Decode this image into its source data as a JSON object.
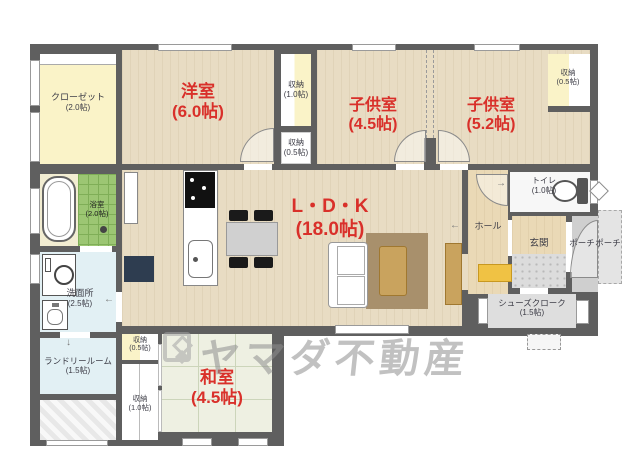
{
  "watermark": {
    "text": "ヤマダ不動産",
    "logo": "yamada-diamond-logo"
  },
  "rooms": {
    "closet": {
      "label": "クローゼット",
      "size": "(2.0帖)"
    },
    "west_room": {
      "label": "洋室",
      "size": "(6.0帖)"
    },
    "storage_a": {
      "label": "収納",
      "size": "(1.0帖)"
    },
    "storage_b": {
      "label": "収納",
      "size": "(0.5帖)"
    },
    "kids_room_1": {
      "label": "子供室",
      "size": "(4.5帖)"
    },
    "kids_room_2": {
      "label": "子供室",
      "size": "(5.2帖)"
    },
    "storage_c": {
      "label": "収納",
      "size": "(0.5帖)"
    },
    "toilet": {
      "label": "トイレ",
      "size": "(1.0帖)"
    },
    "hall": {
      "label": "ホール",
      "size": ""
    },
    "genkan": {
      "label": "玄関",
      "size": ""
    },
    "porch": {
      "label": "ポーチ",
      "size": ""
    },
    "porch_outer": {
      "label": "ポーチ",
      "size": ""
    },
    "shoes_closet": {
      "label": "シューズクローク",
      "size": "(1.5帖)"
    },
    "ldk": {
      "label": "L・D・K",
      "size": "(18.0帖)"
    },
    "bath": {
      "label": "浴室",
      "size": "(2.0帖)"
    },
    "washroom": {
      "label": "洗面所",
      "size": "(2.5帖)"
    },
    "laundry": {
      "label": "ランドリールーム",
      "size": "(1.5帖)"
    },
    "storage_d": {
      "label": "収納",
      "size": "(0.5帖)"
    },
    "storage_e": {
      "label": "収納",
      "size": "(1.0帖)"
    },
    "washitsu": {
      "label": "和室",
      "size": "(4.5帖)"
    }
  },
  "arrows": {
    "hall": "←",
    "washroom": "←",
    "toilet": "→",
    "laundry": "↓"
  },
  "furniture_icons": [
    "bathtub-icon",
    "shower-icon",
    "washing-machine-icon",
    "vanity-sink-icon",
    "refrigerator-icon",
    "kitchen-counter",
    "cooktop-icon",
    "kitchen-sink-icon",
    "dining-table",
    "chair",
    "sofa",
    "rug",
    "coffee-table",
    "tv-board",
    "shoe-cabinet-icon",
    "toilet-icon"
  ],
  "colors": {
    "wall": "#5f5f5f",
    "wood_floor": "#e8dcc3",
    "entry_wood": "#ead9b6",
    "tatami": "#eef0e2",
    "closet_yellow": "#faf3c8",
    "wet_blue": "#e2f0f4",
    "bath_green": "#9cc673",
    "tile_gray": "#dcdcdc",
    "room_label_red": "#d9302a",
    "small_label_gray": "#3c3c46",
    "rug_brown": "#a8906c",
    "furniture_tan": "#c9a35e",
    "shoe_cabinet_yellow": "#f0c244",
    "refrigerator_navy": "#2e3d50",
    "watermark_gray": "#8f8f8f"
  }
}
